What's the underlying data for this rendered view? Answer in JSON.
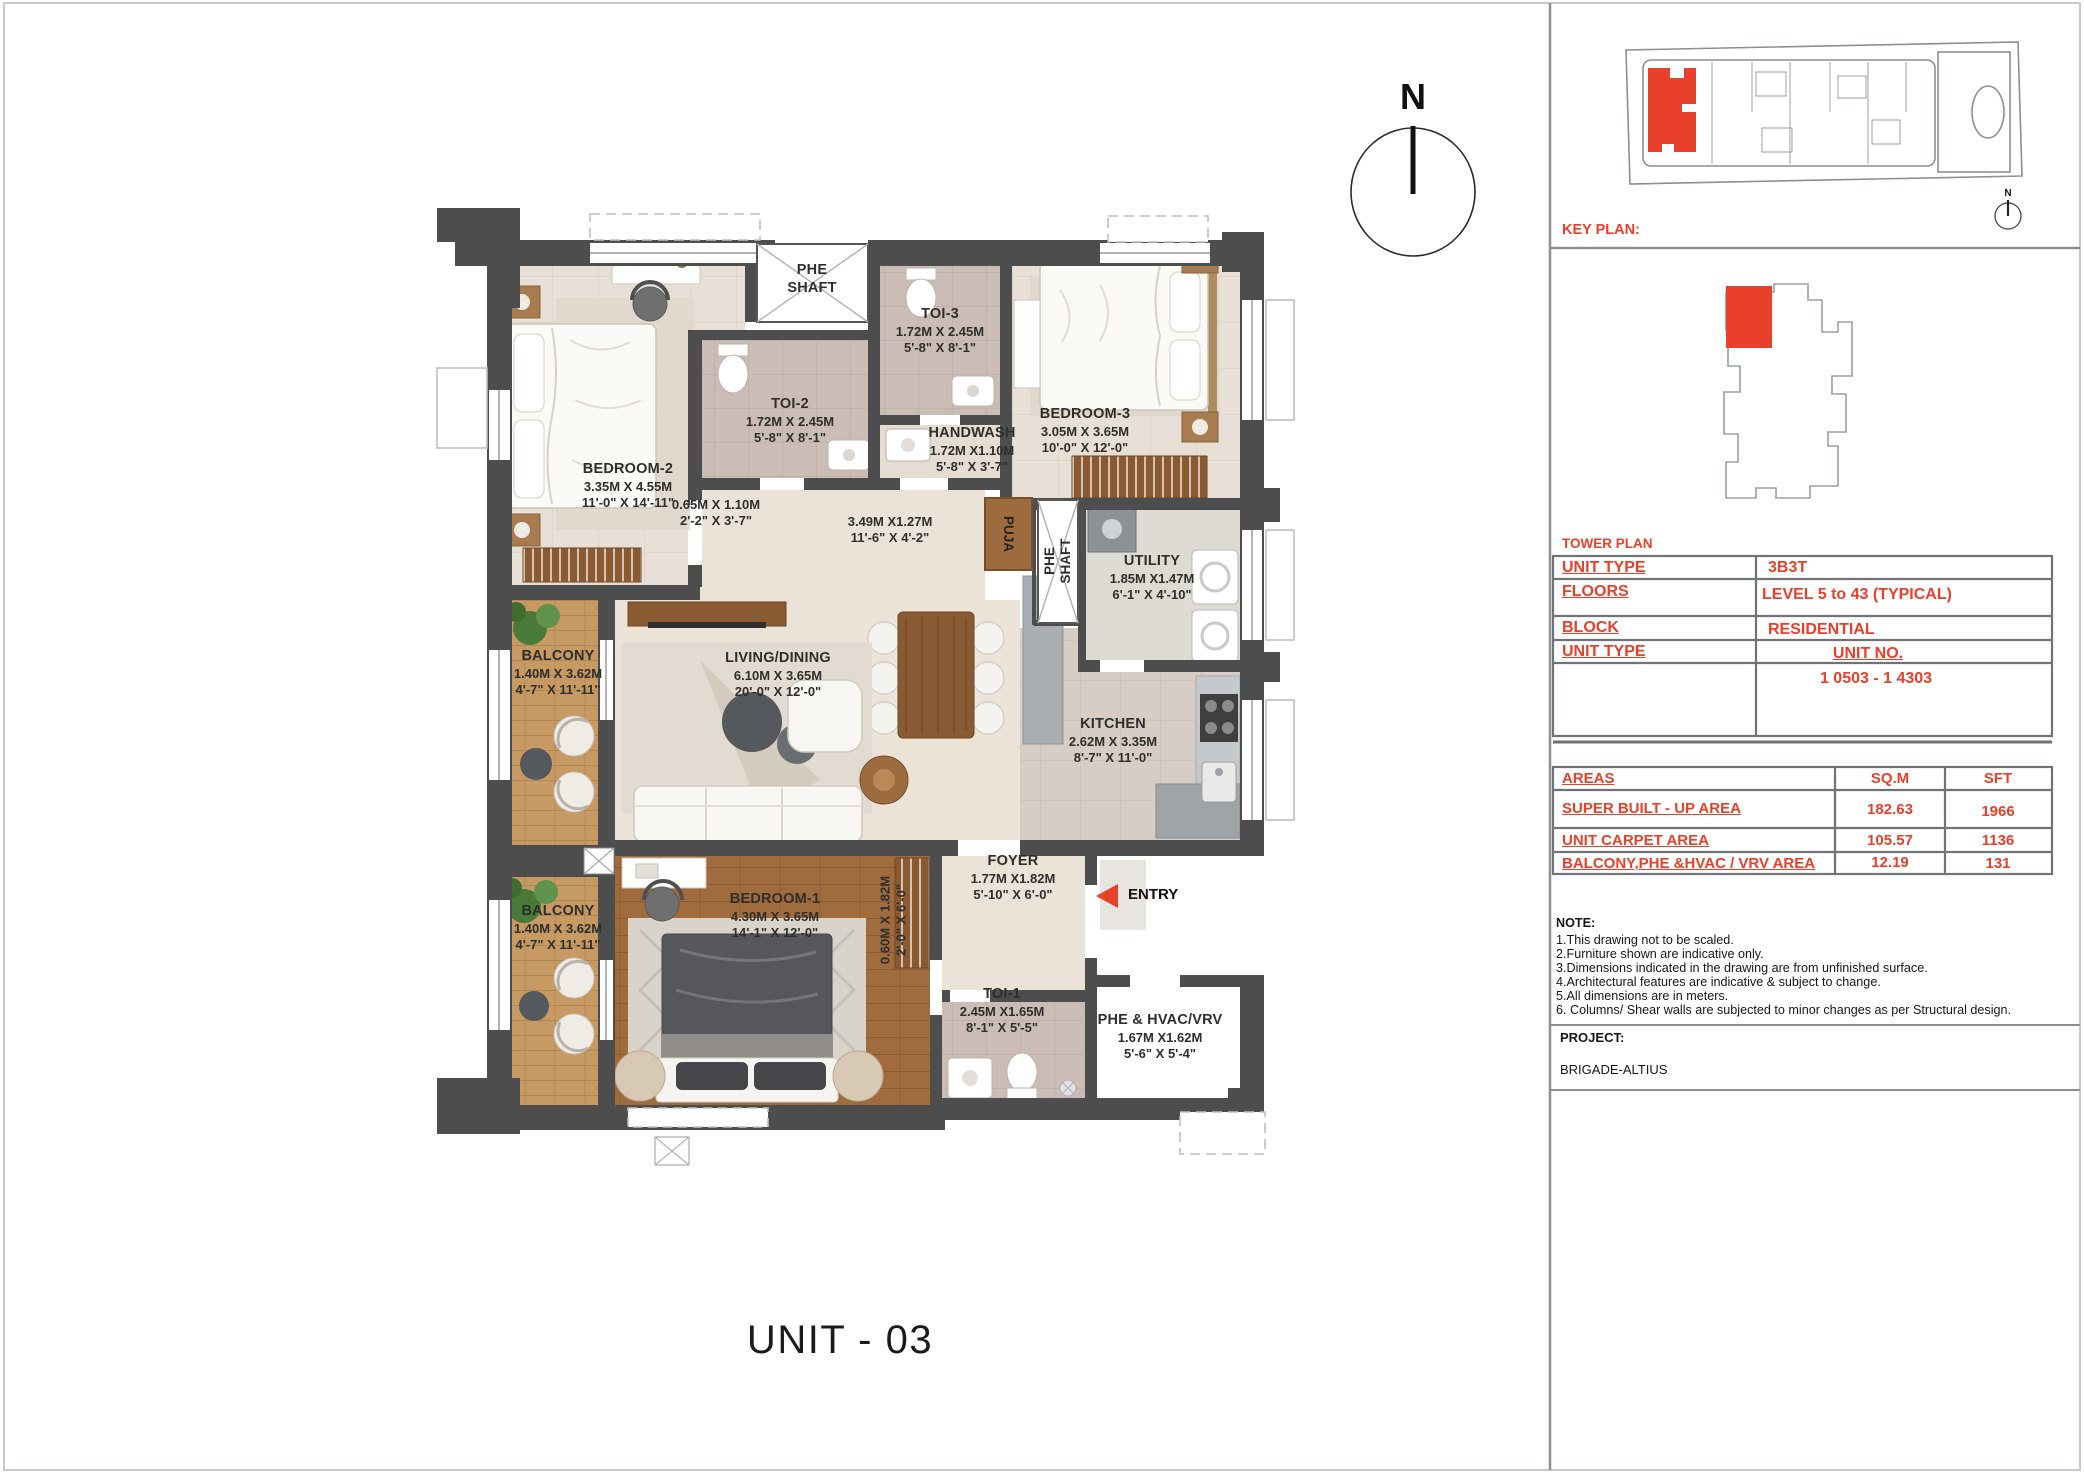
{
  "page": {
    "title": "UNIT - 03"
  },
  "compass": {
    "label": "N"
  },
  "plan": {
    "rooms": [
      {
        "name": "BEDROOM-2",
        "metric": "3.35M X 4.55M",
        "imperial": "11'-0\" X 14'-11\""
      },
      {
        "name": "TOI-2",
        "metric": "1.72M X 2.45M",
        "imperial": "5'-8\" X 8'-1\""
      },
      {
        "name": "TOI-3",
        "metric": "1.72M X 2.45M",
        "imperial": "5'-8\" X 8'-1\""
      },
      {
        "name": "HANDWASH",
        "metric": "1.72M X1.10M",
        "imperial": "5'-8\" X 3'-7\""
      },
      {
        "name": "BEDROOM-3",
        "metric": "3.05M X 3.65M",
        "imperial": "10'-0\" X 12'-0\""
      },
      {
        "name": "BALCONY",
        "metric": "1.40M X 3.62M",
        "imperial": "4'-7\" X 11'-11\""
      },
      {
        "name": "LIVING/DINING",
        "metric": "6.10M X 3.65M",
        "imperial": "20'-0\" X 12'-0\""
      },
      {
        "name": "KITCHEN",
        "metric": "2.62M X 3.35M",
        "imperial": "8'-7\" X 11'-0\""
      },
      {
        "name": "UTILITY",
        "metric": "1.85M X1.47M",
        "imperial": "6'-1\" X 4'-10\""
      },
      {
        "name": "BALCONY",
        "metric": "1.40M X 3.62M",
        "imperial": "4'-7\" X 11'-11\""
      },
      {
        "name": "BEDROOM-1",
        "metric": "4.30M X 3.65M",
        "imperial": "14'-1\" X 12'-0\""
      },
      {
        "name": "FOYER",
        "metric": "1.77M X1.82M",
        "imperial": "5'-10\" X 6'-0\""
      },
      {
        "name": "TOI-1",
        "metric": "2.45M X1.65M",
        "imperial": "8'-1\" X 5'-5\""
      },
      {
        "name": "PHE & HVAC/VRV",
        "metric": "1.67M X1.62M",
        "imperial": "5'-6\" X 5'-4\""
      }
    ],
    "shafts": {
      "top1": "PHE",
      "top2": "SHAFT",
      "mid1": "PHE",
      "mid2": "SHAFT",
      "puja": "PUJA"
    },
    "passages": [
      {
        "metric": "0.65M X 1.10M",
        "imperial": "2'-2\" X 3'-7\""
      },
      {
        "metric": "3.49M X1.27M",
        "imperial": "11'-6\" X 4'-2\""
      },
      {
        "metric": "0.60M X 1.82M",
        "imperial": "2'-0\" X 6'-0\""
      }
    ],
    "entry_label": "ENTRY"
  },
  "panel": {
    "key_plan_label": "KEY PLAN:",
    "tower_plan_label": "TOWER PLAN",
    "north_label": "N",
    "info_rows": [
      [
        "UNIT TYPE",
        "3B3T"
      ],
      [
        "FLOORS",
        "LEVEL 5 to 43 (TYPICAL)"
      ],
      [
        "BLOCK",
        "RESIDENTIAL"
      ],
      [
        "UNIT TYPE",
        "UNIT NO."
      ],
      [
        "",
        "1 0503 - 1 4303"
      ]
    ],
    "areas_table": {
      "headers": [
        "AREAS",
        "SQ.M",
        "SFT"
      ],
      "rows": [
        [
          "SUPER BUILT - UP AREA",
          "182.63",
          "1966"
        ],
        [
          "UNIT CARPET AREA",
          "105.57",
          "1136"
        ],
        [
          "BALCONY,PHE &HVAC / VRV AREA",
          "12.19",
          "131"
        ]
      ]
    },
    "note_title": "NOTE:",
    "notes": [
      "1.This drawing not to be scaled.",
      "2.Furniture shown are indicative only.",
      "3.Dimensions indicated in the drawing are from unfinished surface.",
      "4.Architectural  features are indicative & subject to change.",
      "5.All dimensions are in meters.",
      "6. Columns/ Shear walls are subjected to minor changes as per Structural design."
    ],
    "project_label": "PROJECT:",
    "project_name": "BRIGADE-ALTIUS"
  }
}
